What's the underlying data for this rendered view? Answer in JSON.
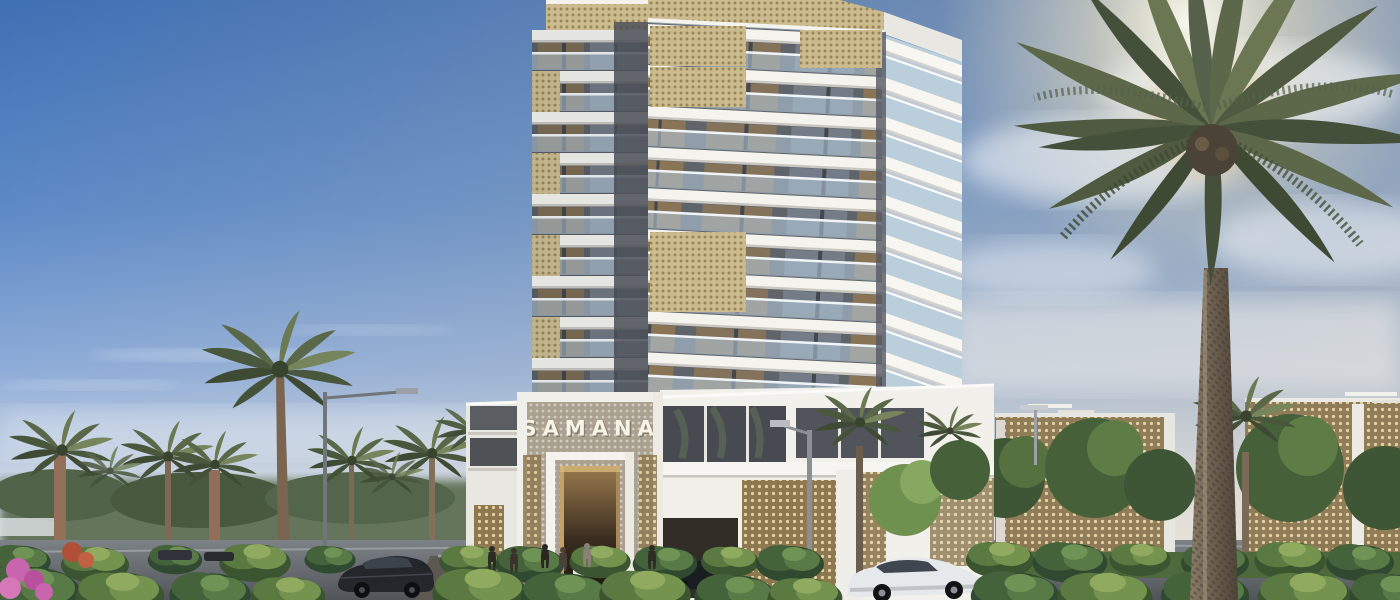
{
  "scene": {
    "description": "Sunlit architectural rendering of a white residential tower with gold lattice balconies, palm-lined street, landscaped bushes, cars and pedestrians",
    "time_of_day": "late afternoon",
    "sign": {
      "text": "SAMANA",
      "color": "#f7f3e6"
    },
    "building": {
      "floors_visible": 11,
      "facade_white": "#f3f2ec",
      "facade_dark": "#585c63",
      "lattice_gold": "#cbbb8e",
      "lattice_bronze": "#8d7850",
      "balustrade_glass": "#b9d0df"
    },
    "sky": {
      "top": "#3f6fb4",
      "mid": "#7fa2d0",
      "horizon": "#e9eae8",
      "sun_glow": "#fff4d8"
    },
    "landscape": {
      "palms_left": 6,
      "big_palm_right": 1,
      "foliage_dark": "#33512f",
      "foliage_light": "#7da05c",
      "flower_pink": "#c964ae",
      "lawn": "#4e6a3c"
    },
    "road_color": "#6c7176",
    "vehicles": [
      {
        "type": "dark-sedan-left",
        "color": "#23262b"
      },
      {
        "type": "dark-car-entrance",
        "color": "#1c1f23"
      },
      {
        "type": "white-crossover-right",
        "color": "#e6e9ec"
      }
    ],
    "pedestrians": 6
  }
}
